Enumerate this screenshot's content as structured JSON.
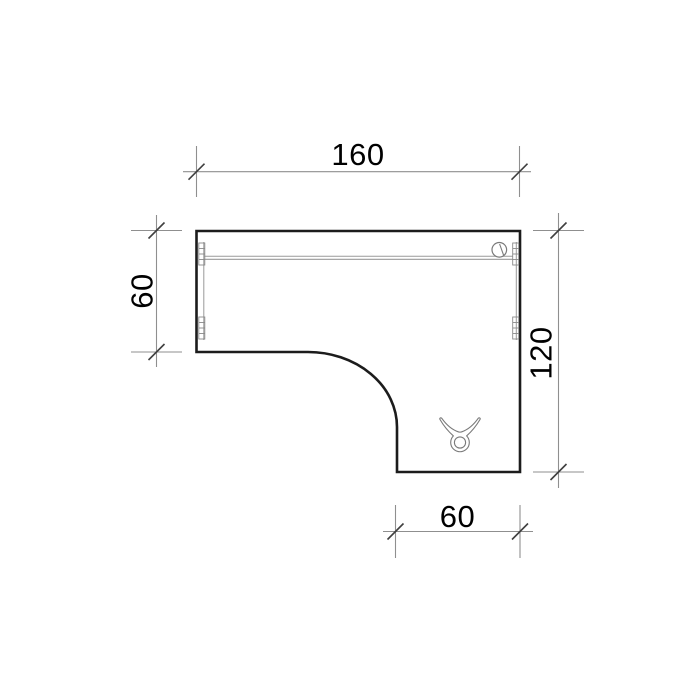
{
  "drawing": {
    "labels": {
      "top": "160",
      "left": "60",
      "right": "120",
      "bottom": "60"
    },
    "colors": {
      "background": "#ffffff",
      "outline": "#1c1c1c",
      "dimension_line": "#8f8f8f",
      "tick": "#3f3f3f",
      "detail_line": "#9a9a9a",
      "symbol_line": "#7a7a7a",
      "label_text": "#000000"
    }
  }
}
